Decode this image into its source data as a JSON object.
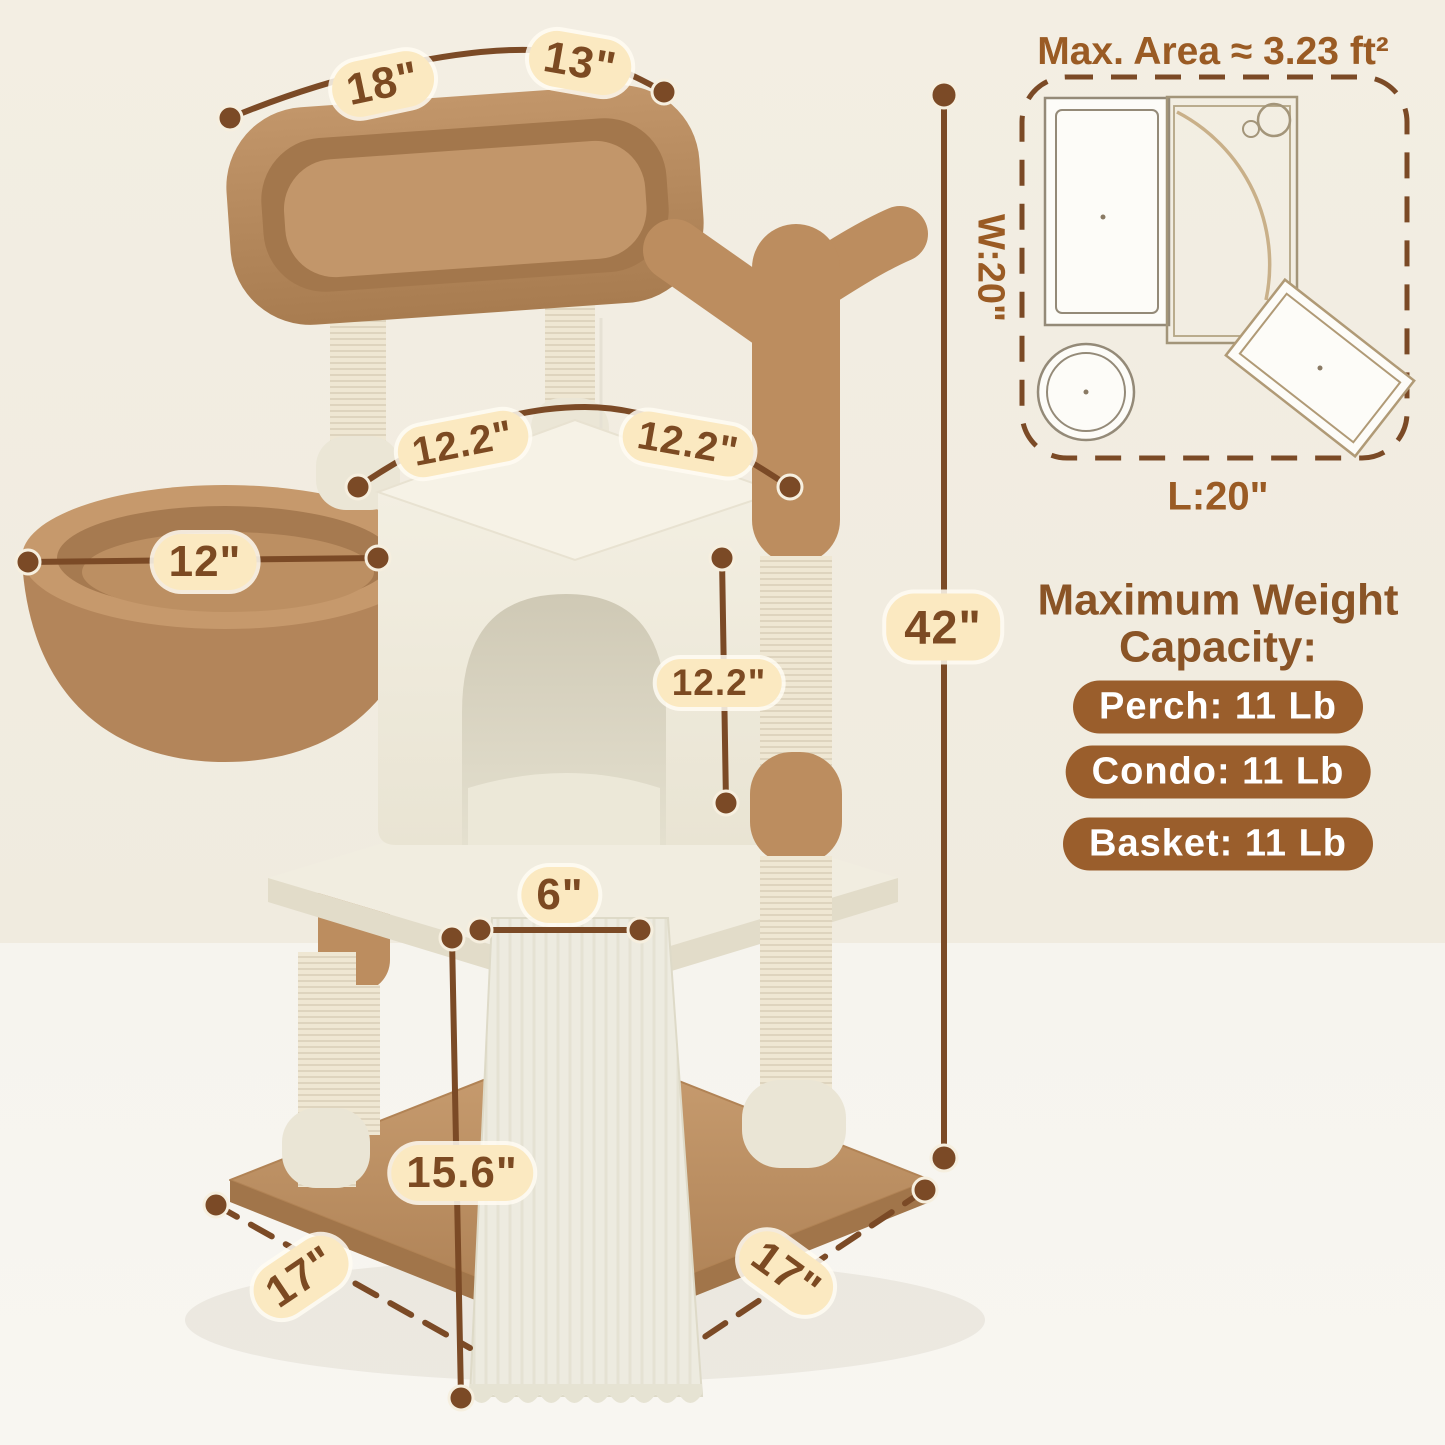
{
  "annotations": {
    "perch_length": "18\"",
    "perch_width": "13\"",
    "roof_left": "12.2\"",
    "roof_right": "12.2\"",
    "basket_diameter": "12\"",
    "condo_height": "12.2\"",
    "total_height": "42\"",
    "platform_gap": "6\"",
    "ramp_height": "15.6\"",
    "base_left": "17\"",
    "base_right": "17\""
  },
  "floor_plan": {
    "title": "Max. Area ≈ 3.23 ft²",
    "width_label": "W:20\"",
    "length_label": "L:20\""
  },
  "weight_capacity": {
    "heading_line1": "Maximum Weight",
    "heading_line2": "Capacity:",
    "badges": [
      "Perch: 11 Lb",
      "Condo: 11 Lb",
      "Basket: 11 Lb"
    ]
  },
  "colors": {
    "accent_line": "#7b4a26",
    "pill_bg": "#fbe9c1",
    "pill_text": "#7c4a22",
    "badge_bg": "#9a5e2c",
    "heading_text": "#8a5426",
    "plush_brown": "#bc8d5f",
    "plush_cream": "#f0ecdf",
    "sisal": "#efe7d3",
    "wall_bg": "#f2ede2",
    "floor_bg": "#f7f5f0"
  }
}
